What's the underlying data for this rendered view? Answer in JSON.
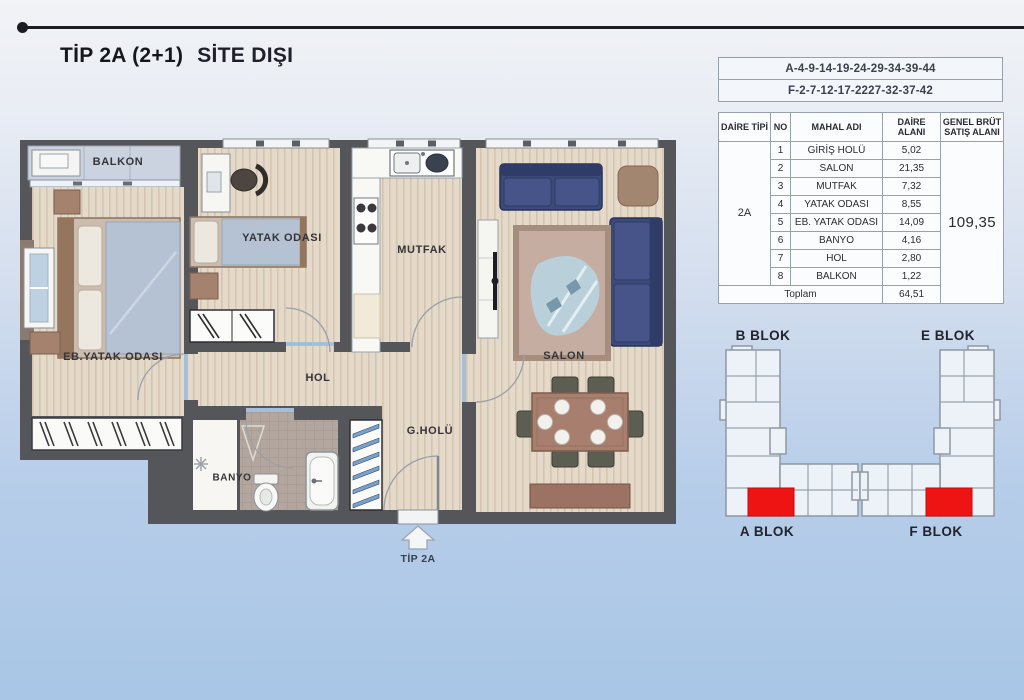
{
  "header": {
    "title_type": "TİP 2A (2+1)",
    "title_suffix": "SİTE DIŞI"
  },
  "unit_codes": {
    "line1": "A-4-9-14-19-24-29-34-39-44",
    "line2": "F-2-7-12-17-2227-32-37-42"
  },
  "area_table": {
    "col_daire_tipi": "DAİRE TİPİ",
    "col_no": "NO",
    "col_mahal": "MAHAL ADI",
    "col_daire_alani": "DAİRE ALANI",
    "col_genel_brut": "GENEL BRÜT SATIŞ ALANI",
    "daire_tipi": "2A",
    "rows": [
      {
        "no": "1",
        "name": "GİRİŞ HOLÜ",
        "area": "5,02"
      },
      {
        "no": "2",
        "name": "SALON",
        "area": "21,35"
      },
      {
        "no": "3",
        "name": "MUTFAK",
        "area": "7,32"
      },
      {
        "no": "4",
        "name": "YATAK ODASI",
        "area": "8,55"
      },
      {
        "no": "5",
        "name": "EB. YATAK ODASI",
        "area": "14,09"
      },
      {
        "no": "6",
        "name": "BANYO",
        "area": "4,16"
      },
      {
        "no": "7",
        "name": "HOL",
        "area": "2,80"
      },
      {
        "no": "8",
        "name": "BALKON",
        "area": "1,22"
      }
    ],
    "toplam_label": "Toplam",
    "toplam_value": "64,51",
    "genel_brut_value": "109,35"
  },
  "floor_plan": {
    "labels": {
      "balkon": "BALKON",
      "yatak_odasi": "YATAK ODASI",
      "mutfak": "MUTFAK",
      "salon": "SALON",
      "eb_yatak_odasi": "EB.YATAK ODASI",
      "hol": "HOL",
      "g_holu": "G.HOLÜ",
      "banyo": "BANYO"
    },
    "entrance_label": "TİP 2A"
  },
  "blocks": {
    "b_label": "B BLOK",
    "a_label": "A BLOK",
    "e_label": "E BLOK",
    "f_label": "F BLOK"
  },
  "colors": {
    "highlight_red": "#ee1414",
    "wall_gray": "#55565a",
    "sofa_navy": "#3c4a79",
    "background_bottom": "#a9c6e6"
  }
}
